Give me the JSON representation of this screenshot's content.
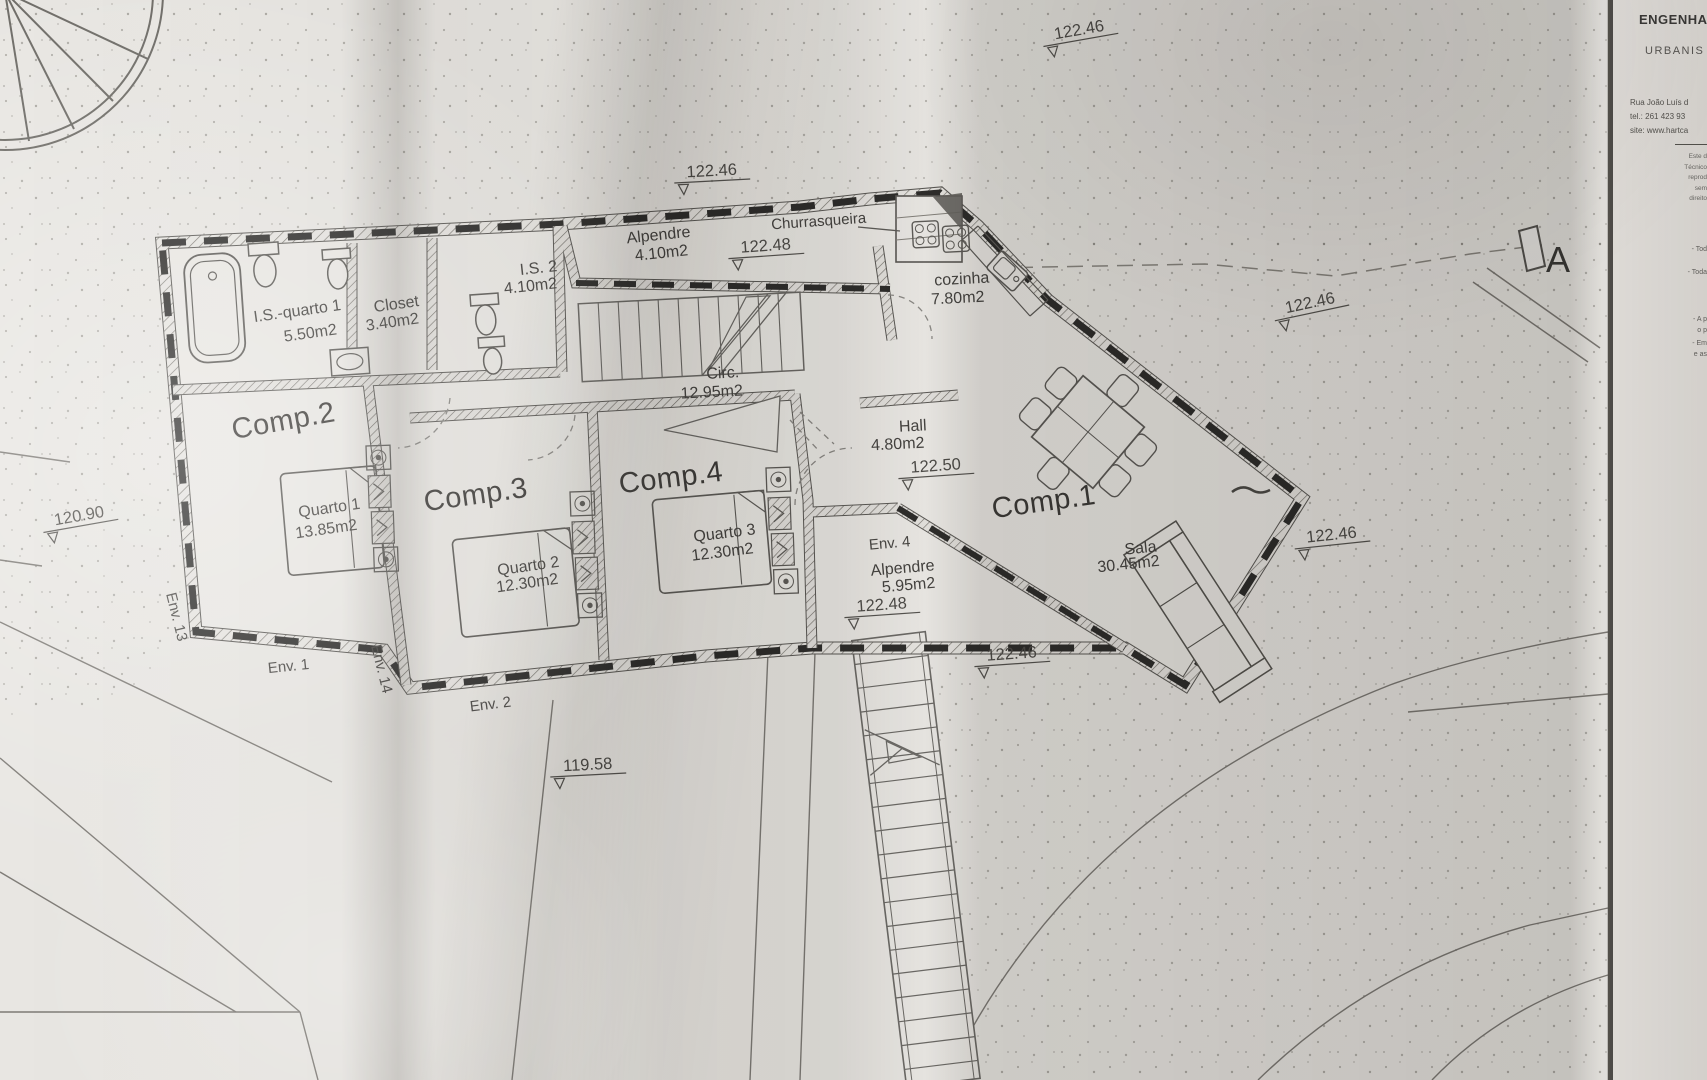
{
  "title_block": {
    "company_line1": "ENGENHA",
    "company_line2": "URBANIS",
    "address_line": "Rua João Luís d",
    "tel_line": "tel.: 261 423 93",
    "site_line": "site: www.hartca",
    "fine_print": [
      "Este d",
      "Técnico",
      "reprod",
      "sem",
      "direito"
    ],
    "notes": [
      "- Tod",
      "- Toda",
      "- A p",
      "o p",
      "- Em",
      "e as"
    ]
  },
  "section_marker": "A",
  "rooms": {
    "is_quarto1": {
      "name": "I.S.-quarto 1",
      "area": "5.50m2"
    },
    "closet": {
      "name": "Closet",
      "area": "3.40m2"
    },
    "is2": {
      "name": "I.S. 2",
      "area": "4.10m2"
    },
    "alpendre_top": {
      "name": "Alpendre",
      "area": "4.10m2"
    },
    "churrasqueira": {
      "name": "Churrasqueira"
    },
    "cozinha": {
      "name": "cozinha",
      "area": "7.80m2"
    },
    "circ": {
      "name": "Circ.",
      "area": "12.95m2"
    },
    "hall": {
      "name": "Hall",
      "area": "4.80m2"
    },
    "comp1": {
      "name": "Comp.1"
    },
    "sala": {
      "name": "Sala",
      "area": "30.45m2"
    },
    "comp2": {
      "name": "Comp.2"
    },
    "quarto1": {
      "name": "Quarto 1",
      "area": "13.85m2"
    },
    "comp3": {
      "name": "Comp.3"
    },
    "quarto2": {
      "name": "Quarto 2",
      "area": "12.30m2"
    },
    "comp4": {
      "name": "Comp.4"
    },
    "quarto3": {
      "name": "Quarto 3",
      "area": "12.30m2"
    },
    "env4_alpendre": {
      "name": "Alpendre",
      "area": "5.95m2"
    }
  },
  "env_labels": {
    "env1": "Env. 1",
    "env2": "Env. 2",
    "env4": "Env. 4",
    "env13": "Env. 13",
    "env14": "Env. 14"
  },
  "elevations": {
    "top_center": "122.46",
    "top_right": "122.46",
    "alpendre_top": "122.48",
    "right": "122.46",
    "hall": "122.50",
    "env4": "122.48",
    "mid_south": "122.46",
    "south_east": "122.46",
    "west": "120.90",
    "south": "119.58"
  },
  "colors": {
    "paper": "#e8e6e2",
    "ink": "#454340",
    "wall_dark": "#2e2d2b",
    "hatch": "#77746e"
  }
}
